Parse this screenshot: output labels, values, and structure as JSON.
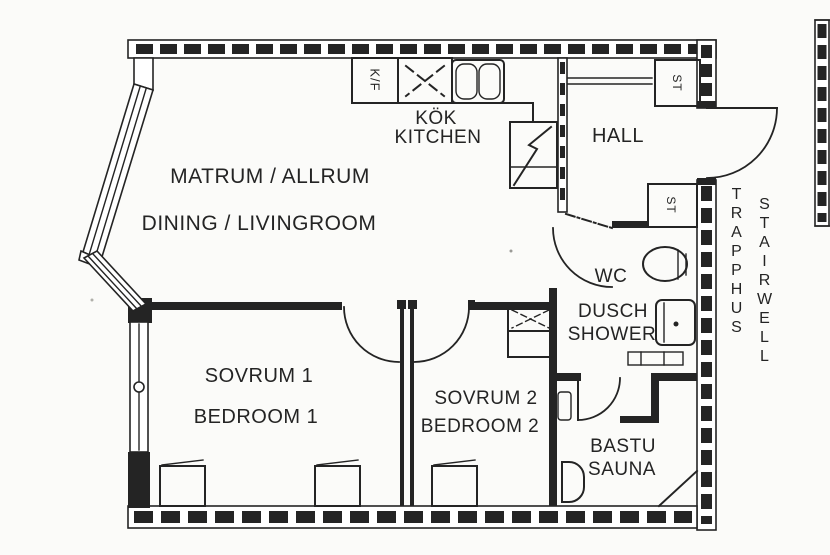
{
  "colors": {
    "ink": "#242424",
    "paper": "#fbfbf9"
  },
  "plan": {
    "living_room": {
      "swedish": "MATRUM / ALLRUM",
      "english": "DINING / LIVINGROOM"
    },
    "kitchen": {
      "swedish": "KÖK",
      "english": "KITCHEN"
    },
    "hall": {
      "swedish": "HALL"
    },
    "bathroom": {
      "wc": "WC",
      "swedish": "DUSCH",
      "english": "SHOWER"
    },
    "bedroom_1": {
      "swedish": "SOVRUM 1",
      "english": "BEDROOM 1"
    },
    "bedroom_2": {
      "swedish": "SOVRUM 2",
      "english": "BEDROOM 2"
    },
    "sauna": {
      "swedish": "BASTU",
      "english": "SAUNA"
    },
    "stairwell": {
      "swedish": "TRAPPHUS",
      "english": "STAIRWELL"
    },
    "fixture_labels": {
      "fridge_freezer": "K/F",
      "hall_closet": "ST",
      "bathroom_closet": "ST"
    }
  }
}
